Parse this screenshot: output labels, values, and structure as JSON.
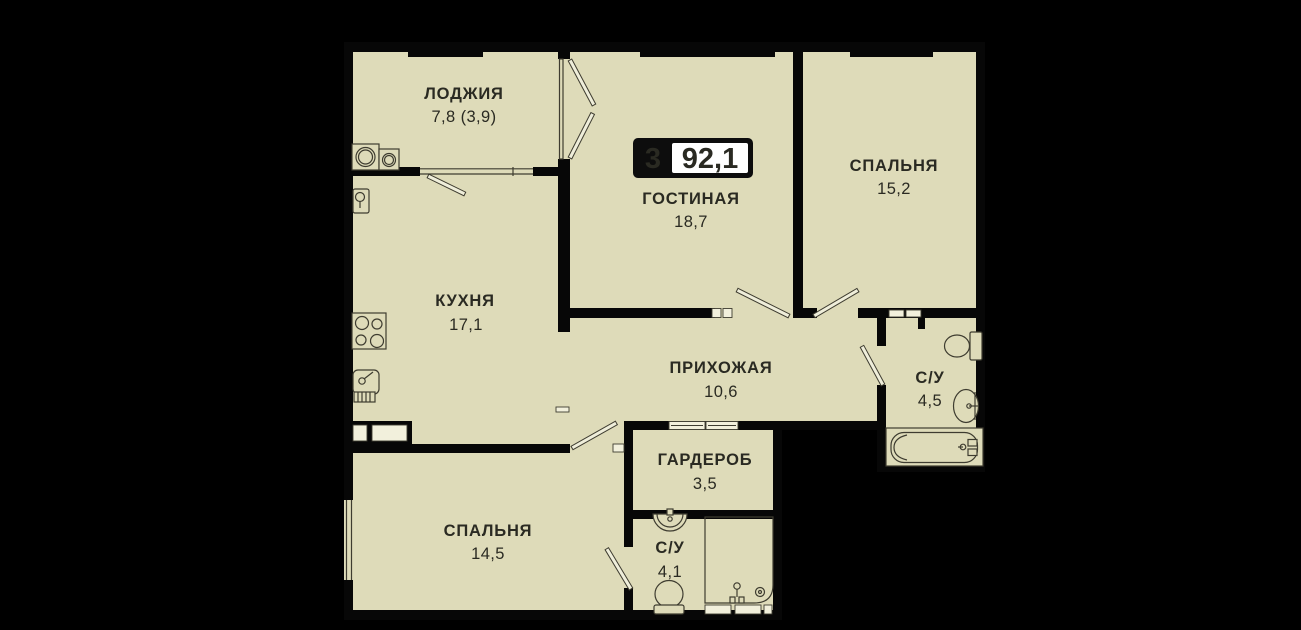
{
  "floor_plan": {
    "badge": {
      "room_count": "3",
      "total_area": "92,1"
    },
    "rooms": [
      {
        "key": "loggia",
        "label": "ЛОДЖИЯ",
        "area": "7,8 (3,9)"
      },
      {
        "key": "living-room",
        "label": "ГОСТИНАЯ",
        "area": "18,7"
      },
      {
        "key": "bedroom-right",
        "label": "СПАЛЬНЯ",
        "area": "15,2"
      },
      {
        "key": "kitchen",
        "label": "КУХНЯ",
        "area": "17,1"
      },
      {
        "key": "hallway",
        "label": "ПРИХОЖАЯ",
        "area": "10,6"
      },
      {
        "key": "bathroom-main",
        "label": "С/У",
        "area": "4,5"
      },
      {
        "key": "wardrobe",
        "label": "ГАРДЕРОБ",
        "area": "3,5"
      },
      {
        "key": "bedroom-bottom",
        "label": "СПАЛЬНЯ",
        "area": "14,5"
      },
      {
        "key": "bathroom-second",
        "label": "С/У",
        "area": "4,1"
      }
    ],
    "colors": {
      "background": "#000000",
      "floor": "#dedbb9",
      "wall": "#070707",
      "fixture_outline": "#3e3c30",
      "badge_bg": "#0d0d0d",
      "badge_value_bg": "#ffffff"
    }
  }
}
